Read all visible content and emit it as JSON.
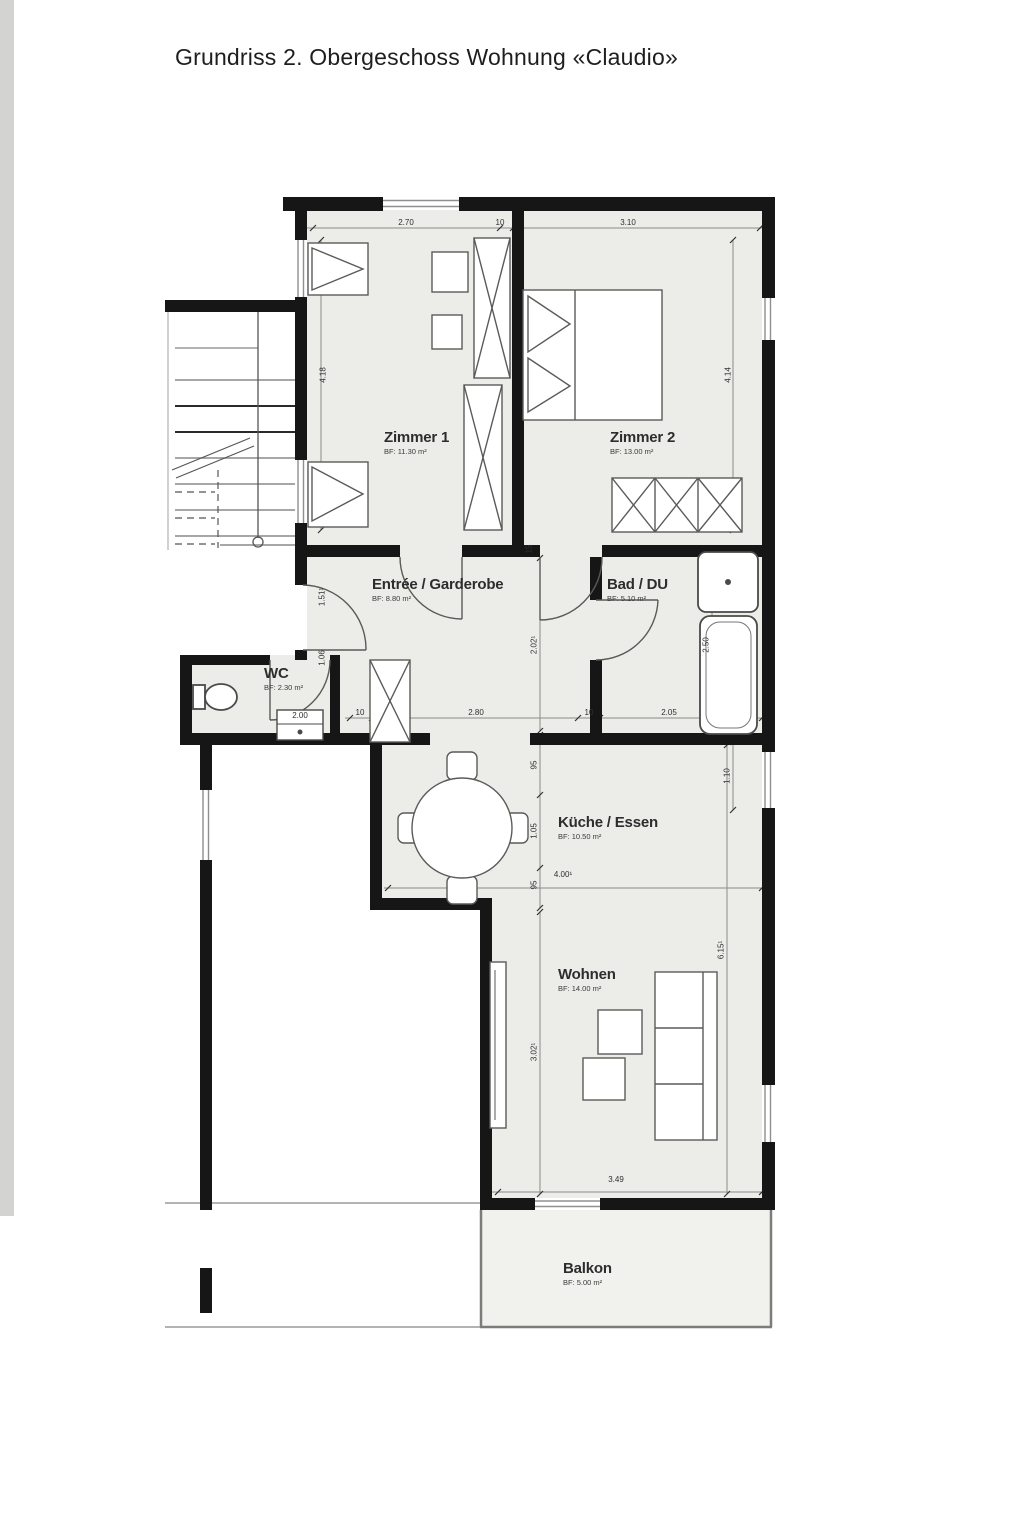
{
  "title": "Grundriss 2. Obergeschoss Wohnung «Claudio»",
  "rooms": {
    "zimmer1": {
      "name": "Zimmer 1",
      "area": "BF: 11.30 m²"
    },
    "zimmer2": {
      "name": "Zimmer 2",
      "area": "BF: 13.00 m²"
    },
    "entree": {
      "name": "Entrée / Garderobe",
      "area": "BF: 8.80 m²"
    },
    "bad": {
      "name": "Bad / DU",
      "area": "BF: 5.10 m²"
    },
    "wc": {
      "name": "WC",
      "area": "BF: 2.30 m²"
    },
    "kueche": {
      "name": "Küche / Essen",
      "area": "BF: 10.50 m²"
    },
    "wohnen": {
      "name": "Wohnen",
      "area": "BF: 14.00 m²"
    },
    "balkon": {
      "name": "Balkon",
      "area": "BF: 5.00 m²"
    }
  },
  "dimensions": {
    "top_left": "2.70",
    "top_wall": "10",
    "top_right": "3.10",
    "left_height": "4.18",
    "right_height": "4.14",
    "entree_left_1": "1.51¹",
    "entree_left_2": "1.06",
    "wc_fixture": "2.00",
    "chain_wall_1": "10",
    "chain_entree": "2.80",
    "chain_wall_2": "10",
    "chain_bad": "2.05",
    "entree_height": "2.02¹",
    "tub_length": "2.50",
    "wall_15": "15",
    "kueche_window": "1.10",
    "kueche_opening_top": "95",
    "kueche_height": "1.05",
    "kueche_opening_bottom": "95",
    "kueche_width": "4.00¹",
    "wohnen_height": "3.02¹",
    "right_total": "6.15¹",
    "balkon_width": "3.49"
  },
  "colors": {
    "wall": "#161616",
    "room_fill": "#ecece9",
    "line": "#6f6f6f"
  }
}
